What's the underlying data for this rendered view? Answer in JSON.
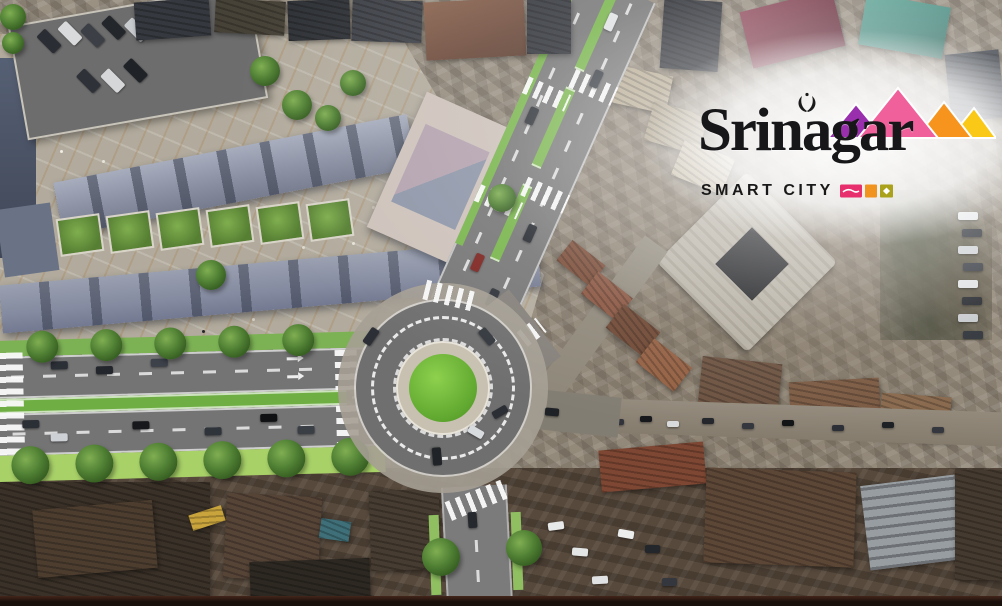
{
  "image": {
    "subject": "Srinagar Smart City aerial redevelopment visualization",
    "scene": "3D street render (roundabout, tree-lined boulevard, market plaza) composited over old-city aerial photograph"
  },
  "logo": {
    "wordmark": "Srinagar",
    "tagline": "SMART CITY",
    "ornament": "paisley-pair-icon",
    "colors": {
      "text": "#17171a",
      "peak_purple": "#9a2fae",
      "peak_pink": "#f0609b",
      "peak_orange": "#f6941e",
      "peak_yellow": "#fac816"
    },
    "badges": [
      {
        "name": "shikara-badge",
        "color": "#e72f6d"
      },
      {
        "name": "square-badge",
        "color": "#f0941f"
      },
      {
        "name": "gem-badge",
        "color": "#aaa21a"
      }
    ]
  },
  "scene": {
    "colors": {
      "road_gray": "#747474",
      "roundabout_center_green": "#6fbe3c",
      "median_green": "#74b04a",
      "cycle_track_green": "#a8d168",
      "plaza_paving": "#b2ab9d",
      "rust_rooftop": "#7d4733",
      "bottom_border_band": "#20130d"
    },
    "features": [
      "roundabout",
      "tree-lined-boulevard",
      "zebra-crossings",
      "lane-arrows",
      "market-plaza",
      "parking-lot",
      "old-city-rooftops",
      "courtyard-building",
      "green-medians",
      "street-traffic"
    ]
  }
}
